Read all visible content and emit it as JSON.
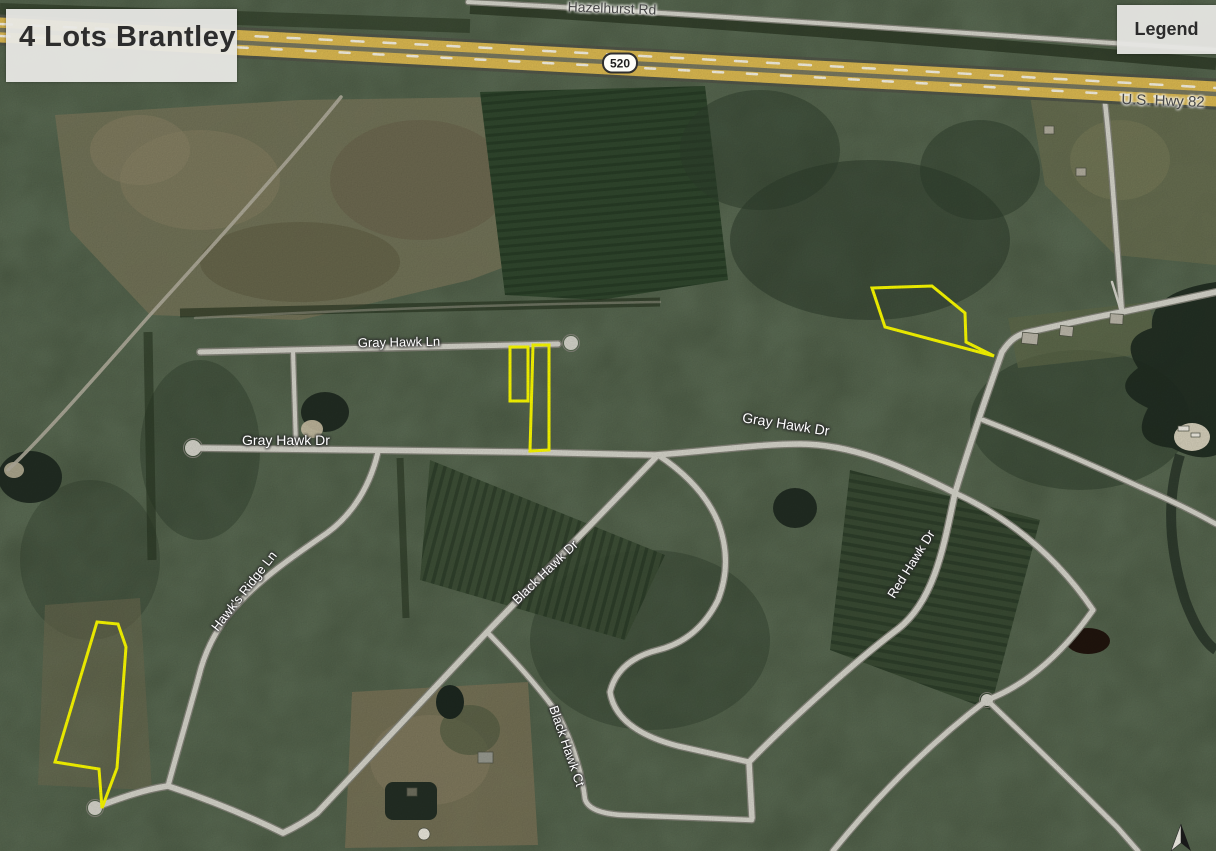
{
  "title": "4 Lots Brantley",
  "legend": {
    "label": "Legend"
  },
  "map": {
    "highway_shield": "520",
    "labels": {
      "hazelhurst_rd": "Hazelhurst Rd",
      "us_hwy_82": "U.S. Hwy 82",
      "gray_hawk_ln": "Gray Hawk Ln",
      "gray_hawk_dr_west": "Gray Hawk Dr",
      "gray_hawk_dr_east": "Gray Hawk Dr",
      "hawks_ridge_ln": "Hawk's Ridge Ln",
      "black_hawk_dr": "Black Hawk Dr",
      "black_hawk_ct": "Black Hawk Ct",
      "red_hawk_dr": "Red Hawk Dr"
    },
    "lots": {
      "count": 4,
      "outline_color": "#ffff00"
    },
    "colors": {
      "highway": "#dfbc52",
      "road": "#d8d7cd",
      "water": "#1f2b21"
    }
  }
}
